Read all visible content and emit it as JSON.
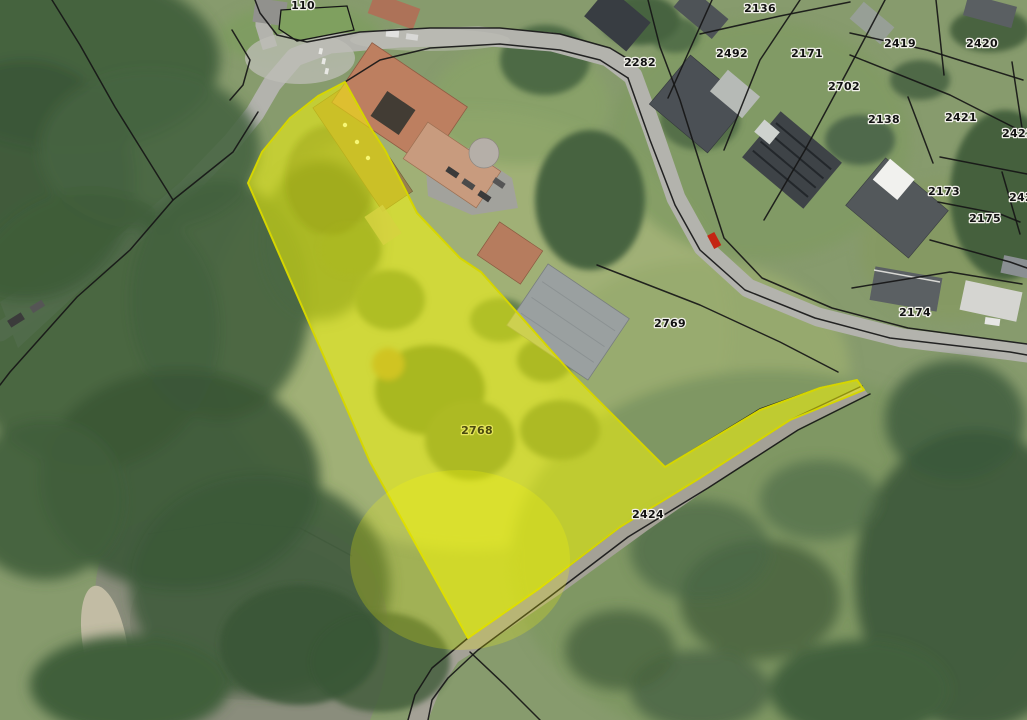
{
  "map": {
    "type": "aerial-cadastral-view",
    "highlighted_parcel_number": "2768",
    "colors": {
      "highlight_fill": "#ffff00",
      "highlight_stroke": "#d6d600",
      "boundary": "#161616",
      "label_text": "#111111",
      "label_halo": "#f0efe9",
      "highlight_label_text": "#4a4a10",
      "highlight_label_halo": "#e4e45a"
    },
    "parcel_labels": [
      {
        "text": "110",
        "x": 303,
        "y": 9
      },
      {
        "text": "2136",
        "x": 760,
        "y": 12
      },
      {
        "text": "2282",
        "x": 640,
        "y": 66
      },
      {
        "text": "2492",
        "x": 732,
        "y": 57
      },
      {
        "text": "2171",
        "x": 807,
        "y": 57
      },
      {
        "text": "2419",
        "x": 900,
        "y": 47
      },
      {
        "text": "2420",
        "x": 982,
        "y": 47
      },
      {
        "text": "2702",
        "x": 844,
        "y": 90
      },
      {
        "text": "2138",
        "x": 884,
        "y": 123
      },
      {
        "text": "2421",
        "x": 961,
        "y": 121
      },
      {
        "text": "2422",
        "x": 1018,
        "y": 137
      },
      {
        "text": "2173",
        "x": 944,
        "y": 195
      },
      {
        "text": "242",
        "x": 1021,
        "y": 201
      },
      {
        "text": "2175",
        "x": 985,
        "y": 222
      },
      {
        "text": "2174",
        "x": 915,
        "y": 316
      },
      {
        "text": "2769",
        "x": 670,
        "y": 327
      },
      {
        "text": "2424",
        "x": 648,
        "y": 518
      },
      {
        "text": "2768",
        "x": 477,
        "y": 434,
        "on_highlight": true
      }
    ]
  }
}
